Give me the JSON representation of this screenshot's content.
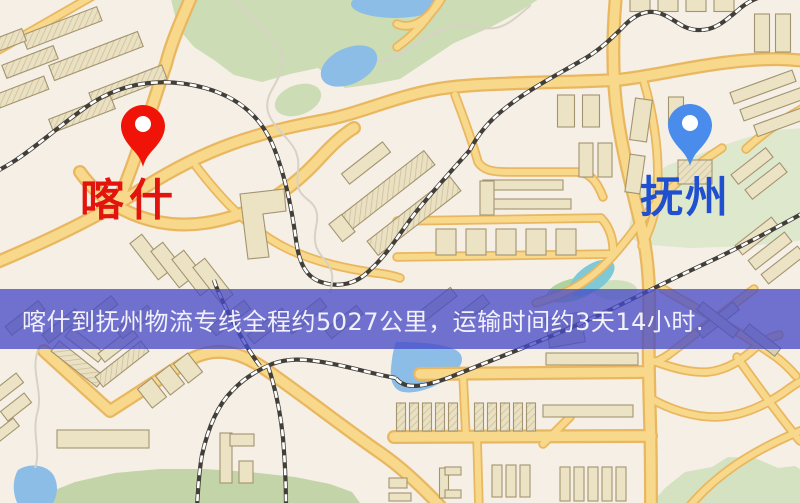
{
  "map": {
    "markers": [
      {
        "id": "origin",
        "label": "喀什",
        "pin_color": "#f01408",
        "label_color": "#e3140d"
      },
      {
        "id": "destination",
        "label": "抚州",
        "pin_color": "#4a8cec",
        "label_color": "#2050cf"
      }
    ],
    "banner": {
      "text": "喀什到抚州物流专线全程约5027公里，运输时间约3天14小时.",
      "bg_color": "rgba(70,74,200,0.76)",
      "text_color": "#f2f0fb",
      "route": {
        "origin": "喀什",
        "destination": "抚州",
        "distance": "约5027公里",
        "duration": "约3天14小时"
      }
    }
  }
}
